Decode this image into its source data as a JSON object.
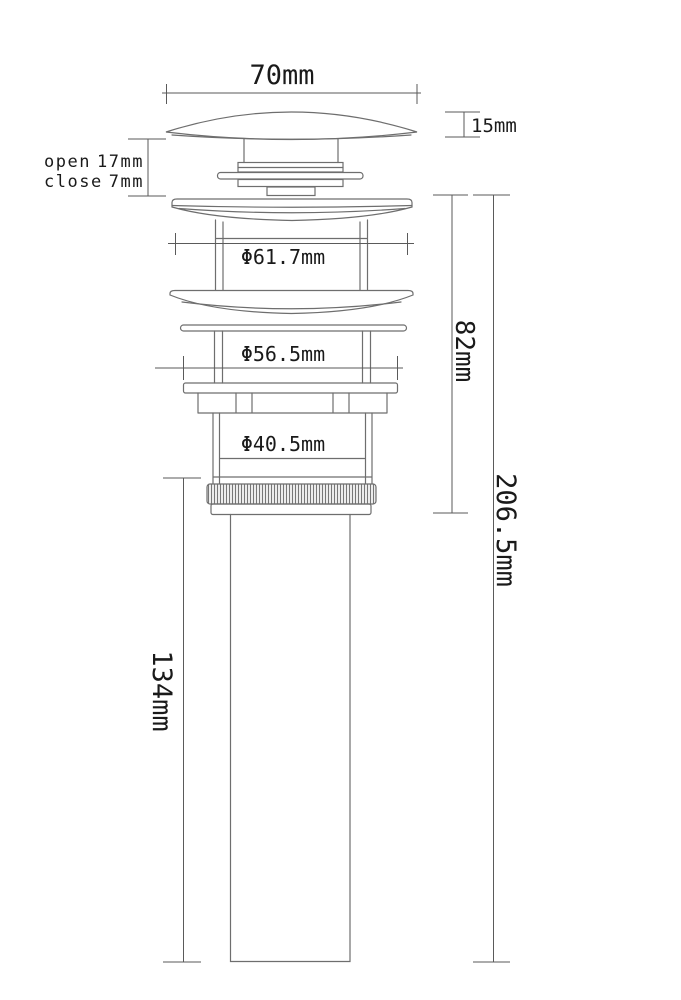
{
  "page": {
    "background": "#ffffff",
    "part_line_color": "#6e6e6e",
    "dim_line_color": "#5a5a5a",
    "text_color": "#1a1a1a"
  },
  "labels": {
    "cap_width": "70mm",
    "cap_height": "15mm",
    "open_label": "open",
    "open_value": "17mm",
    "close_label": "close",
    "close_value": "7mm",
    "flange_diameter": "Φ61.7mm",
    "washer_diameter": "Φ56.5mm",
    "body_diameter": "Φ40.5mm",
    "upper_height": "82mm",
    "total_height": "206.5mm",
    "tailpipe_height": "134mm"
  }
}
